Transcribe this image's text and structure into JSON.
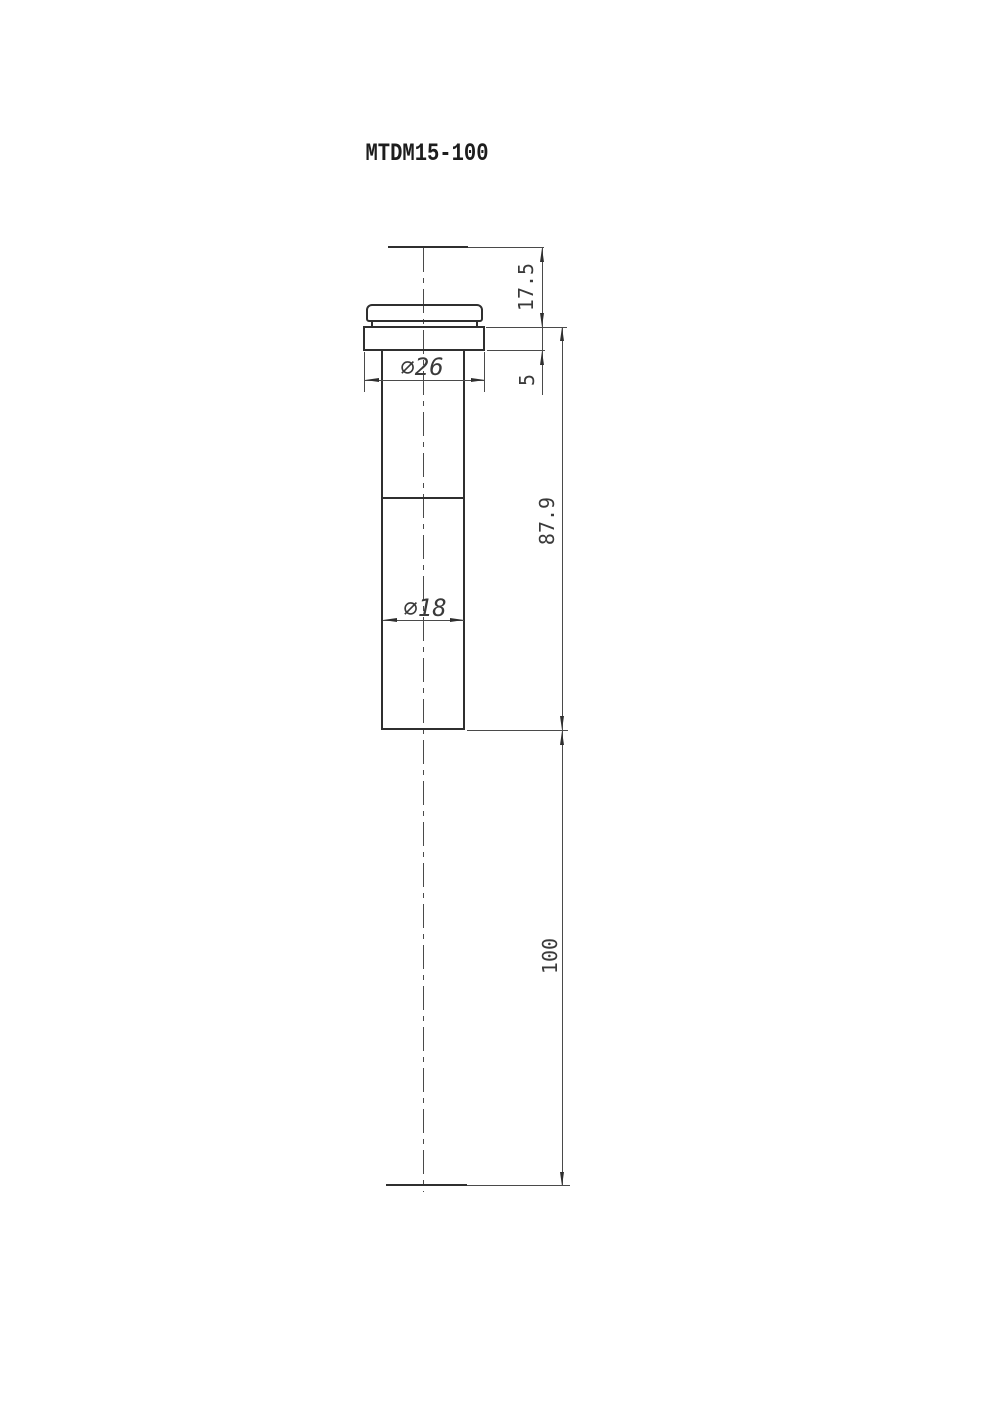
{
  "title": "MTDM15-100",
  "colors": {
    "background": "#ffffff",
    "object_line": "#2f2f2f",
    "thin_line": "#4a4a4a",
    "text": "#3a3a3a"
  },
  "dimensions": {
    "flange_to_image_plane_mm": "17.5",
    "flange_thickness_mm": "5",
    "body_length_mm": "87.9",
    "working_distance_mm": "100",
    "flange_diameter": "⌀26",
    "barrel_diameter": "⌀18"
  }
}
